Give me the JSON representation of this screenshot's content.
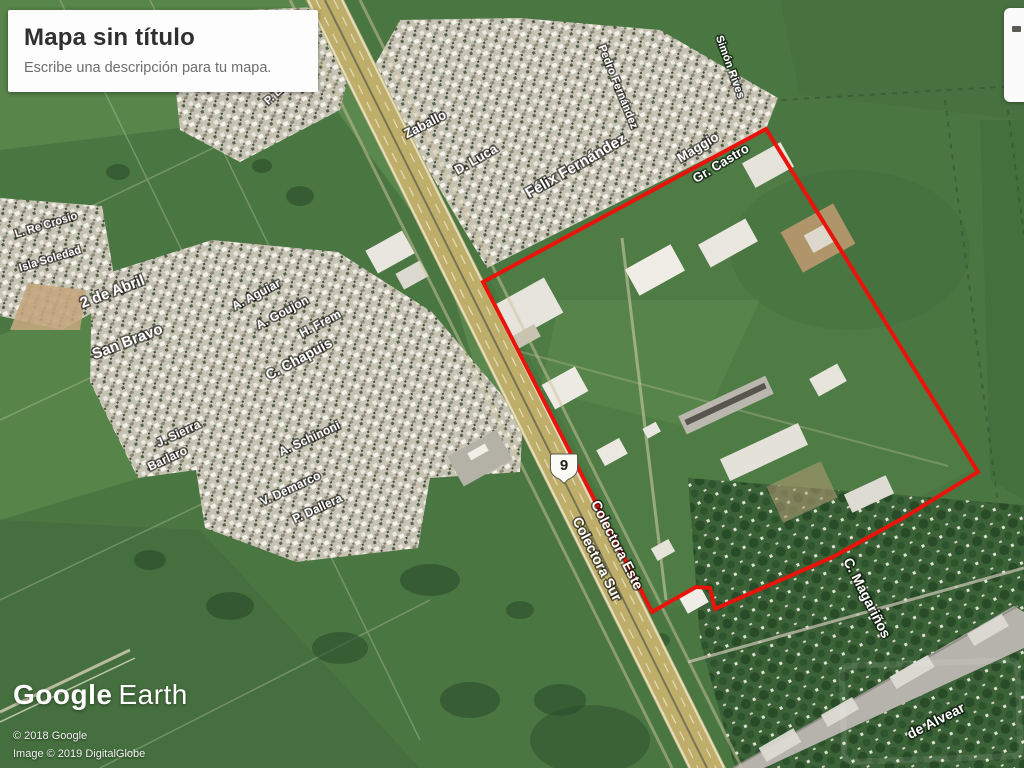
{
  "map_card": {
    "title": "Mapa sin título",
    "subtitle": "Escribe una descripción para tu mapa."
  },
  "logo": {
    "google": "Google",
    "earth": "Earth"
  },
  "attribution": {
    "line1": "© 2018 Google",
    "line2": "Image © 2019 DigitalGlobe"
  },
  "route_shield": {
    "number": "9"
  },
  "colors": {
    "selection_red": "#e8140c",
    "field_green": "#4a7642",
    "label_white": "#ffffff"
  },
  "overlay_polygon": {
    "points": [
      [
        483,
        282
      ],
      [
        766,
        129
      ],
      [
        978,
        472
      ],
      [
        905,
        517
      ],
      [
        833,
        557
      ],
      [
        715,
        609
      ],
      [
        710,
        588
      ],
      [
        696,
        587
      ],
      [
        652,
        612
      ]
    ]
  },
  "street_labels": [
    {
      "text": "Zaballo",
      "x": 427,
      "y": 128,
      "rot": -27,
      "size": 13
    },
    {
      "text": "D. Luca",
      "x": 478,
      "y": 163,
      "rot": -30,
      "size": 13
    },
    {
      "text": "Félix Fernández",
      "x": 578,
      "y": 170,
      "rot": -30,
      "size": 15
    },
    {
      "text": "Maggio",
      "x": 700,
      "y": 151,
      "rot": -31,
      "size": 13
    },
    {
      "text": "Gr. Castro",
      "x": 723,
      "y": 167,
      "rot": -31,
      "size": 13
    },
    {
      "text": "Pedro Fernández",
      "x": 615,
      "y": 88,
      "rot": 68,
      "size": 11
    },
    {
      "text": "Simón Rives",
      "x": 727,
      "y": 68,
      "rot": 70,
      "size": 11
    },
    {
      "text": "P. Elguía",
      "x": 285,
      "y": 90,
      "rot": -42,
      "size": 11
    },
    {
      "text": "L. Re Crosio",
      "x": 47,
      "y": 228,
      "rot": -17,
      "size": 11
    },
    {
      "text": "Isla Soledad",
      "x": 51,
      "y": 262,
      "rot": -17,
      "size": 11
    },
    {
      "text": "2 de Abril",
      "x": 114,
      "y": 296,
      "rot": -21,
      "size": 15
    },
    {
      "text": "San Bravo",
      "x": 129,
      "y": 346,
      "rot": -21,
      "size": 15
    },
    {
      "text": "A. Aguiar",
      "x": 258,
      "y": 298,
      "rot": -28,
      "size": 12
    },
    {
      "text": "A. Goujon",
      "x": 284,
      "y": 316,
      "rot": -28,
      "size": 12
    },
    {
      "text": "H. Frem",
      "x": 322,
      "y": 327,
      "rot": -28,
      "size": 12
    },
    {
      "text": "C. Chapuis",
      "x": 301,
      "y": 363,
      "rot": -28,
      "size": 14
    },
    {
      "text": "J. Sierra",
      "x": 180,
      "y": 437,
      "rot": -25,
      "size": 12
    },
    {
      "text": "Barlaro",
      "x": 169,
      "y": 462,
      "rot": -25,
      "size": 12
    },
    {
      "text": "A. Schinoni",
      "x": 311,
      "y": 442,
      "rot": -25,
      "size": 12
    },
    {
      "text": "V. Demarco",
      "x": 292,
      "y": 492,
      "rot": -25,
      "size": 12
    },
    {
      "text": "P. Dallera",
      "x": 319,
      "y": 512,
      "rot": -25,
      "size": 12
    },
    {
      "text": "Colectora Este",
      "x": 613,
      "y": 547,
      "rot": 63,
      "size": 14
    },
    {
      "text": "Colectora Sur",
      "x": 593,
      "y": 561,
      "rot": 63,
      "size": 14
    },
    {
      "text": "C. Magariños",
      "x": 863,
      "y": 600,
      "rot": 63,
      "size": 14
    },
    {
      "text": "de Alvear",
      "x": 938,
      "y": 725,
      "rot": -27,
      "size": 14
    }
  ]
}
